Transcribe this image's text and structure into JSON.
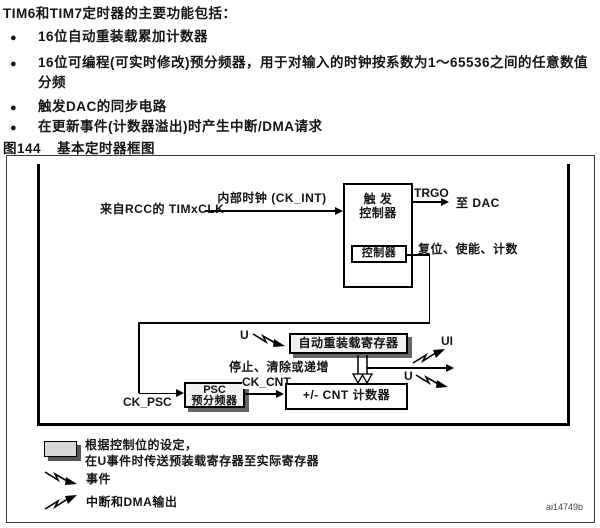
{
  "intro": {
    "title": "TIM6和TIM7定时器的主要功能包括：",
    "bullet_glyph": "●",
    "bullets": [
      "16位自动重装载累加计数器",
      "16位可编程(可实时修改)预分频器，用于对输入的时钟按系数为1～65536之间的任意数值分频",
      "触发DAC的同步电路",
      "在更新事件(计数器溢出)时产生中断/DMA请求"
    ]
  },
  "figure": {
    "caption_number": "图144",
    "caption_title": "基本定时器框图",
    "watermark": "ai14749b"
  },
  "diagram": {
    "input_label": "来自RCC的 TIMxCLK",
    "internal_clock_label": "内部时钟 (CK_INT)",
    "trigger_controller_line1": "触 发",
    "trigger_controller_line2": "控制器",
    "controller_box_label": "控制器",
    "trgo_label": "TRGO",
    "to_dac_label": "至 DAC",
    "control_signals_label": "复位、使能、计数",
    "u_event_label": "U",
    "autoreload_box_label": "自动重装载寄存器",
    "ui_label": "UI",
    "u_label_right": "U",
    "stop_clear_label": "停止、清除或递增",
    "psc_box_line1": "PSC",
    "psc_box_line2": "预分频器",
    "ck_psc_label": "CK_PSC",
    "ck_cnt_label": "CK_CNT",
    "cnt_box_label": "+/- CNT 计数器"
  },
  "legend": {
    "note_line1": "根据控制位的设定，",
    "note_line2": "在U事件时传送预装载寄存器至实际寄存器",
    "event_label": "事件",
    "interrupt_label": "中断和DMA输出"
  },
  "colors": {
    "line": "#000000",
    "register_fill": "#f1f1f1",
    "legend_fill": "#d8d8d8",
    "shadow": "#666666"
  }
}
